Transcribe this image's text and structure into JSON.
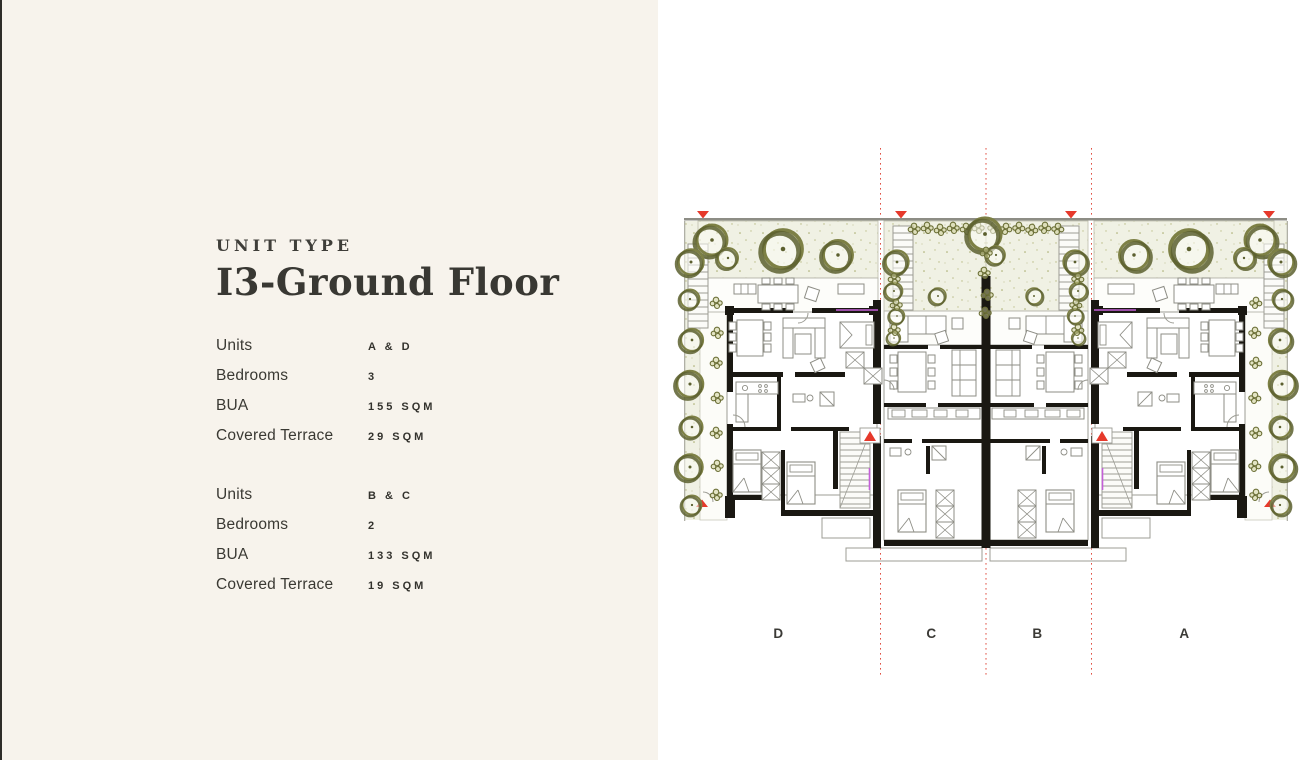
{
  "page": {
    "background_left": "#f7f3ec",
    "background_right": "#ffffff",
    "left_edge_color": "#2e2d29"
  },
  "left_panel": {
    "eyebrow": "UNIT TYPE",
    "title": "I3-Ground Floor",
    "spec_blocks": [
      {
        "rows": [
          {
            "label": "Units",
            "value": "A & D"
          },
          {
            "label": "Bedrooms",
            "value": "3"
          },
          {
            "label": "BUA",
            "value": "155 SQM"
          },
          {
            "label": "Covered Terrace",
            "value": "29 SQM"
          }
        ]
      },
      {
        "rows": [
          {
            "label": "Units",
            "value": "B & C"
          },
          {
            "label": "Bedrooms",
            "value": "2"
          },
          {
            "label": "BUA",
            "value": "133 SQM"
          },
          {
            "label": "Covered Terrace",
            "value": "19 SQM"
          }
        ]
      }
    ]
  },
  "floor_plan": {
    "unit_labels": [
      "D",
      "C",
      "B",
      "A"
    ],
    "colors": {
      "tree_olive": "#7d8045",
      "tree_shadow": "#5c602f",
      "garden_fill": "#f0f1e4",
      "garden_speckle": "#999c55",
      "wall_black": "#1a1812",
      "partition_gray": "#9c9c94",
      "marker_red": "#e6392b",
      "accent_magenta": "#c45fd8",
      "label_color": "#3b3a36"
    }
  }
}
